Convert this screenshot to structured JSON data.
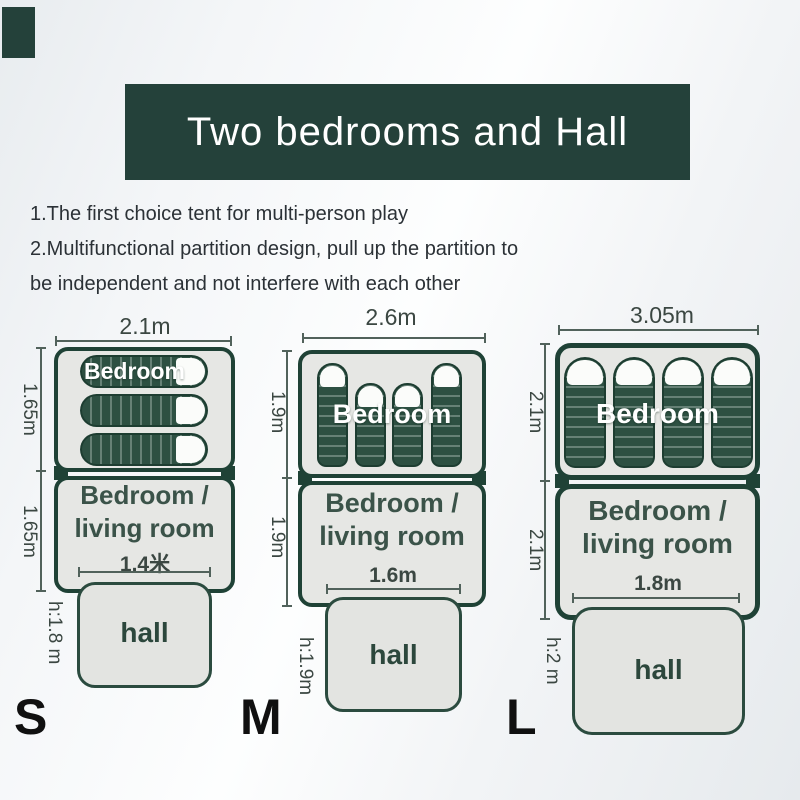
{
  "title_banner": {
    "text": "Two bedrooms and Hall",
    "bg_color": "#24413a",
    "text_color": "#ffffff"
  },
  "features": {
    "lines": [
      "1.The first choice tent for multi-person play",
      "2.Multifunctional partition design, pull up the partition to",
      "be independent and not interfere with each other"
    ]
  },
  "colors": {
    "accent_green": "#24413a",
    "tent_border_green": "#1f4236",
    "sleeping_bag_green": "#2d5042",
    "section_fill": "#e6e7e4",
    "hall_fill": "#e3e4e1",
    "dimension_text": "#3b4742",
    "room_label_text": "#3b5349",
    "size_letter_color": "#101010"
  },
  "sizes": [
    {
      "letter": "S",
      "total_width": "2.1m",
      "bedroom_depth": "1.65m",
      "living_depth": "1.65m",
      "hall_width": "1.4米",
      "hall_height": "h:1.8 m",
      "bedroom_label": "Bedroom",
      "living_label_line1": "Bedroom /",
      "living_label_line2": "living room",
      "hall_label": "hall",
      "sleeping_bag_count": 3
    },
    {
      "letter": "M",
      "total_width": "2.6m",
      "bedroom_depth": "1.9m",
      "living_depth": "1.9m",
      "hall_width": "1.6m",
      "hall_height": "h:1.9m",
      "bedroom_label": "Bedroom",
      "living_label_line1": "Bedroom /",
      "living_label_line2": "living room",
      "hall_label": "hall",
      "sleeping_bag_count": 4
    },
    {
      "letter": "L",
      "total_width": "3.05m",
      "bedroom_depth": "2.1m",
      "living_depth": "2.1m",
      "hall_width": "1.8m",
      "hall_height": "h:2 m",
      "bedroom_label": "Bedroom",
      "living_label_line1": "Bedroom /",
      "living_label_line2": "living room",
      "hall_label": "hall",
      "sleeping_bag_count": 4
    }
  ]
}
